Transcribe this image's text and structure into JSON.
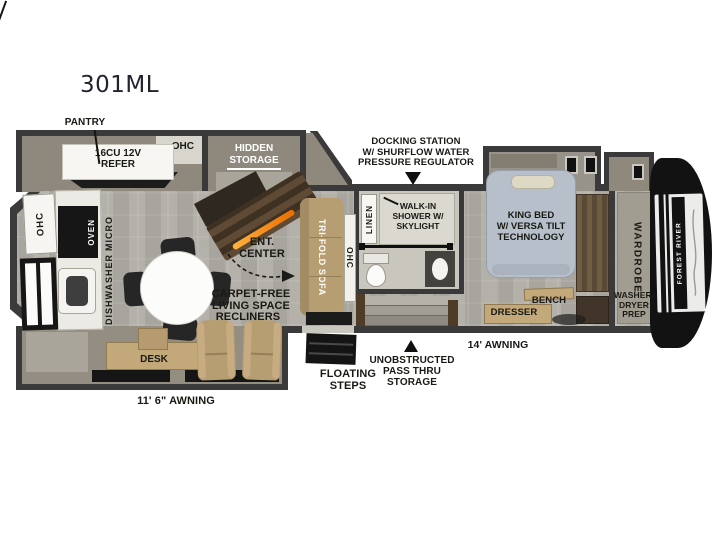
{
  "title": "301ML",
  "colors": {
    "wall": "#3a3a3a",
    "floor": "#b3b0a9",
    "slide_shell": "#8e897c",
    "furniture_tan": "#b79d72",
    "desk_tan": "#c3a87a",
    "bed": "#b7c0ca",
    "counter_white": "#f4f3ef",
    "appliance_black": "#141414",
    "fireplace_glow": "#e96d00",
    "label_text": "#191914",
    "cap_black": "#121212",
    "cap_band": "#ececea"
  },
  "callouts": {
    "pantry": "PANTRY",
    "docking_station": "DOCKING STATION\nW/ SHURFLOW WATER\nPRESSURE REGULATOR",
    "floating_steps": "FLOATING\nSTEPS",
    "pass_thru_storage": "UNOBSTRUCTED\nPASS THRU\nSTORAGE",
    "awning_rear": "11' 6\" AWNING",
    "awning_front": "14' AWNING"
  },
  "kitchen": {
    "refrigerator": "16CU 12V\nREFER",
    "ohc_slide": "OHC",
    "hidden_storage": "HIDDEN\nSTORAGE",
    "ohc_rear_wall": "OHC",
    "oven": "OVEN",
    "micro": "MICRO",
    "dishwasher": "DISHWASHER"
  },
  "living": {
    "ent_center": "ENT.\nCENTER",
    "tri_fold_sofa": "TRI-FOLD SOFA",
    "ohc_sofa": "OHC",
    "carpet_free": "CARPET-FREE\nLIVING SPACE",
    "recliners": "RECLINERS",
    "desk": "DESK"
  },
  "bath": {
    "linen": "LINEN",
    "walk_in_shower": "WALK-IN\nSHOWER W/\nSKYLIGHT"
  },
  "bedroom": {
    "king_bed": "KING BED\nW/ VERSA TILT\nTECHNOLOGY",
    "bench": "BENCH",
    "dresser": "DRESSER",
    "wardrobe": "WARDROBE",
    "washer_dryer_prep": "WASHER/\nDRYER\nPREP"
  },
  "exterior": {
    "brand": "FOREST RIVER"
  },
  "icons": {
    "docking_arrow": "down-triangle",
    "pass_thru_arrow": "up-triangle"
  }
}
